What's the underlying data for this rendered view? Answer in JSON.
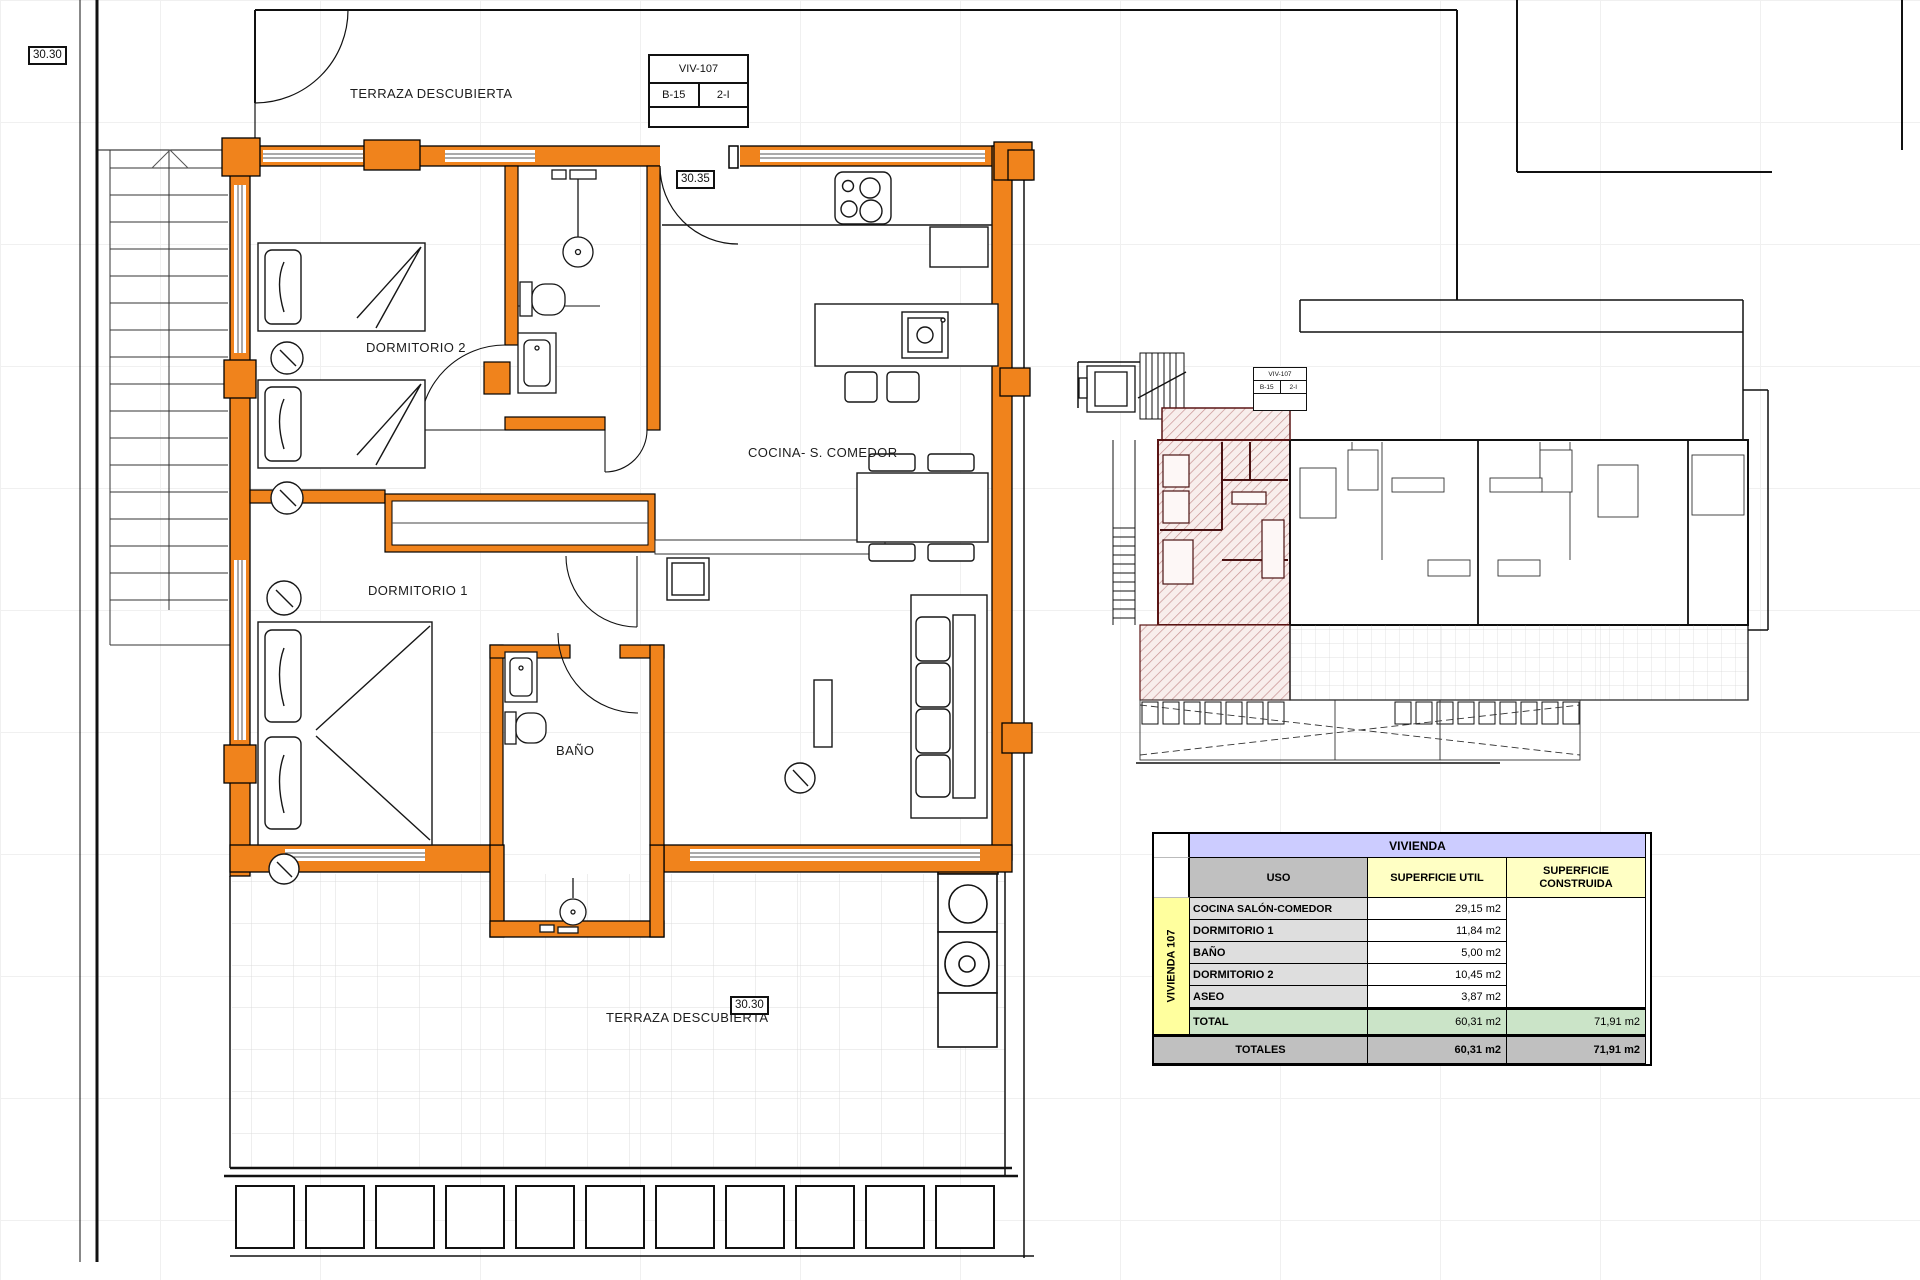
{
  "labels": {
    "level_top_left": "30.30",
    "level_entry": "30.35",
    "level_bottom": "30.30",
    "terraza_top": "TERRAZA DESCUBIERTA",
    "terraza_bottom": "TERRAZA DESCUBIERTA",
    "dormitorio2": "DORMITORIO 2",
    "dormitorio1": "DORMITORIO 1",
    "bano": "BAÑO",
    "cocina": "COCINA- S. COMEDOR"
  },
  "title_block": {
    "unit": "VIV-107",
    "block": "B-15",
    "floor": "2-I"
  },
  "mini_title_block": {
    "unit": "VIV-107",
    "block": "B-15",
    "floor": "2-I"
  },
  "colors": {
    "wall_orange": "#F0831C",
    "highlight_hatch": "#C89292",
    "table_header_lavender": "#CCCCFF",
    "table_header_yellow": "#FFFFC4",
    "table_side_yellow": "#FFFF9E",
    "table_total_green": "#CBE4C8",
    "table_gray": "#C0C0C0"
  },
  "areas_table": {
    "title": "VIVIENDA",
    "side_label": "VIVIENDA 107",
    "col_uso": "USO",
    "col_util": "SUPERFICIE UTIL",
    "col_construida": "SUPERFICIE CONSTRUIDA",
    "rows": [
      {
        "uso": "COCINA SALÓN-COMEDOR",
        "util": "29,15 m2"
      },
      {
        "uso": "DORMITORIO 1",
        "util": "11,84 m2"
      },
      {
        "uso": "BAÑO",
        "util": "5,00 m2"
      },
      {
        "uso": "DORMITORIO 2",
        "util": "10,45 m2"
      },
      {
        "uso": "ASEO",
        "util": "3,87 m2"
      }
    ],
    "total": {
      "label": "TOTAL",
      "util": "60,31 m2",
      "construida": "71,91 m2"
    },
    "totales": {
      "label": "TOTALES",
      "util": "60,31 m2",
      "construida": "71,91 m2"
    }
  }
}
